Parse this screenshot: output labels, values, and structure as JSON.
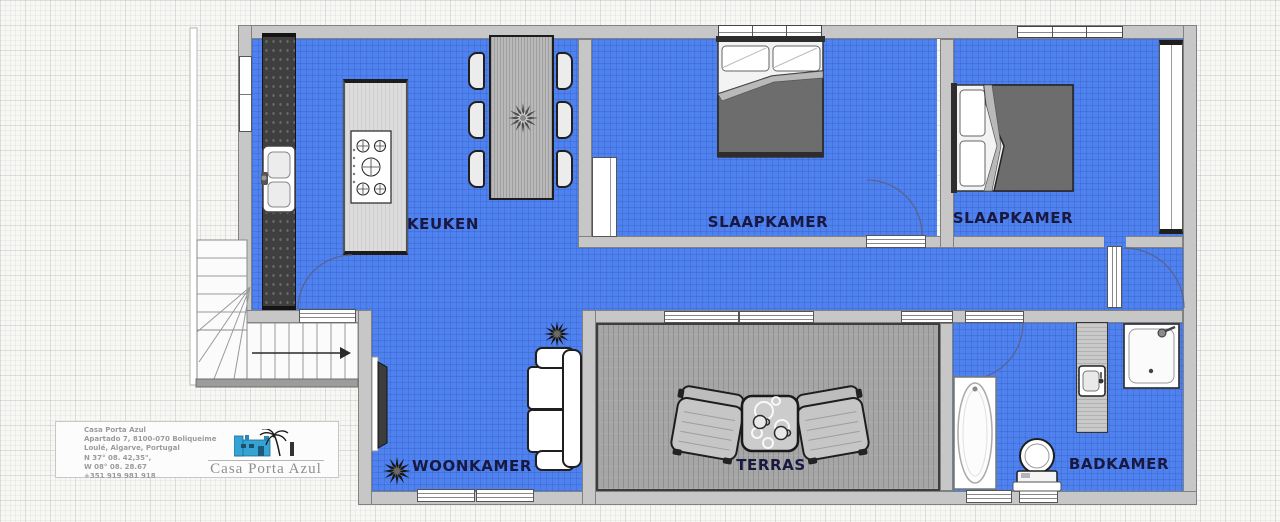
{
  "floorplan": {
    "rooms": [
      {
        "id": "kitchen",
        "label": "KEUKEN"
      },
      {
        "id": "bedroom-1",
        "label": "SLAAPKAMER"
      },
      {
        "id": "bedroom-2",
        "label": "SLAAPKAMER"
      },
      {
        "id": "living-room",
        "label": "WOONKAMER"
      },
      {
        "id": "terrace",
        "label": "TERRAS"
      },
      {
        "id": "bathroom",
        "label": "BADKAMER"
      }
    ],
    "colors": {
      "floor_blue": "#4f82ef",
      "wall_gray": "#c7c7c7",
      "terrace_deck": "#a6a6a6",
      "label_text": "#181840"
    }
  },
  "logo_card": {
    "address_lines": [
      "Casa Porta Azul",
      "Apartado 7, 8100-070 Boliqueime",
      "Loulé, Algarve, Portugal",
      "N 37° 08. 42,35\",",
      "W 08° 08. 28.67",
      "+351 919 981 918"
    ],
    "brand": "Casa Porta Azul"
  }
}
